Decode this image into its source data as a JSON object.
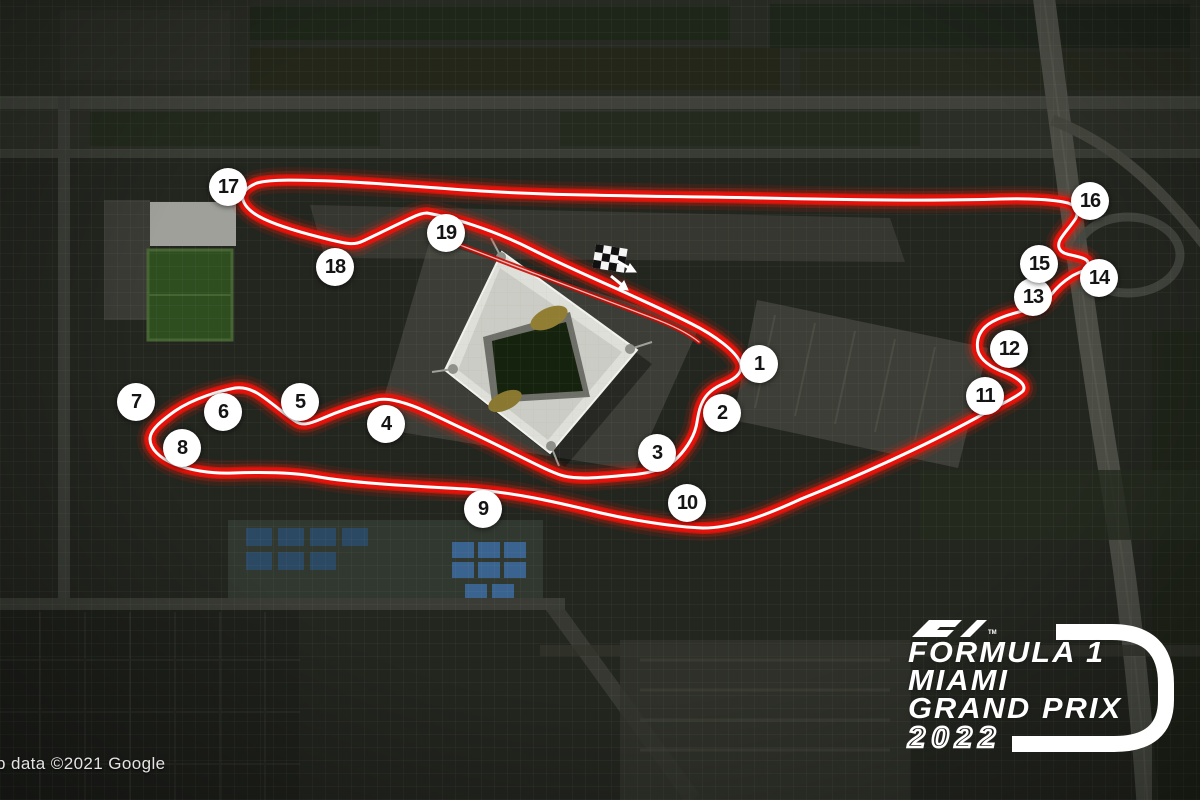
{
  "map": {
    "attribution": "p data ©2021 Google",
    "turns": [
      {
        "n": "1",
        "x": 759,
        "y": 364
      },
      {
        "n": "2",
        "x": 722,
        "y": 413
      },
      {
        "n": "3",
        "x": 657,
        "y": 453
      },
      {
        "n": "4",
        "x": 386,
        "y": 424
      },
      {
        "n": "5",
        "x": 300,
        "y": 402
      },
      {
        "n": "6",
        "x": 223,
        "y": 412
      },
      {
        "n": "7",
        "x": 136,
        "y": 402
      },
      {
        "n": "8",
        "x": 182,
        "y": 448
      },
      {
        "n": "9",
        "x": 483,
        "y": 509
      },
      {
        "n": "10",
        "x": 687,
        "y": 503
      },
      {
        "n": "11",
        "x": 985,
        "y": 396
      },
      {
        "n": "12",
        "x": 1009,
        "y": 349
      },
      {
        "n": "13",
        "x": 1033,
        "y": 297
      },
      {
        "n": "14",
        "x": 1099,
        "y": 278
      },
      {
        "n": "15",
        "x": 1039,
        "y": 264
      },
      {
        "n": "16",
        "x": 1090,
        "y": 201
      },
      {
        "n": "17",
        "x": 228,
        "y": 187
      },
      {
        "n": "18",
        "x": 335,
        "y": 267
      },
      {
        "n": "19",
        "x": 446,
        "y": 233
      }
    ],
    "track": {
      "path": "M 427 213 C 450 217 492 229 533 250 C 574 271 645 300 692 324 C 716 336 735 351 740 362 C 744 371 737 378 725 383 C 713 388 706 394 702 403 C 698 411 698 419 696 427 C 693 439 684 452 674 461 C 663 470 646 474 628 475 C 606 477 581 480 564 476 C 548 472 515 453 470 432 C 446 421 419 407 404 403 C 394 400 385 398 377 400 C 361 404 339 411 321 419 C 309 424 302 426 295 421 C 284 414 269 400 257 393 C 250 389 242 387 235 388 C 220 391 194 398 175 411 C 161 421 150 430 150 439 C 150 449 160 458 174 464 C 189 470 211 474 233 473 C 259 472 293 472 319 477 C 352 483 412 486 466 489 C 512 492 552 501 601 513 C 636 521 676 527 703 528 C 731 528 762 517 801 499 C 851 479 921 448 976 418 C 999 405 1017 397 1023 391 C 1027 385 1018 378 1006 373 C 992 368 981 361 978 351 C 976 341 979 333 985 327 C 993 319 1011 314 1026 310 C 1038 307 1046 302 1051 295 C 1057 287 1064 281 1072 276 C 1081 271 1087 271 1088 264 C 1089 258 1078 257 1067 254 C 1059 252 1057 246 1060 240 C 1064 233 1071 226 1076 218 C 1079 211 1076 206 1068 203 C 1056 200 1031 198 1001 199 C 941 201 852 200 761 198 C 661 196 561 196 481 191 C 431 188 381 183 331 181 C 301 180 271 179 257 183 C 247 187 241 193 243 200 C 245 207 253 214 264 219 C 281 227 306 234 331 240 C 345 243 353 246 363 241 C 376 235 396 225 411 218 C 419 214 423 213 427 213 Z",
      "pit_path": "M 452 242 C 520 268 600 298 650 317 C 672 325 688 333 699 342",
      "glow_color": "#ff1a0a",
      "red_color": "#e8100a",
      "core_color": "#ffffff"
    },
    "start_finish": {
      "flag_icon": "checkered-flag",
      "direction": "southeast"
    }
  },
  "logo": {
    "f1_mark": "F1",
    "tm": "TM",
    "line1": "FORMULA 1",
    "line2": "MIAMI",
    "line3": "GRAND PRIX",
    "year": "2022",
    "color": "#ffffff"
  }
}
